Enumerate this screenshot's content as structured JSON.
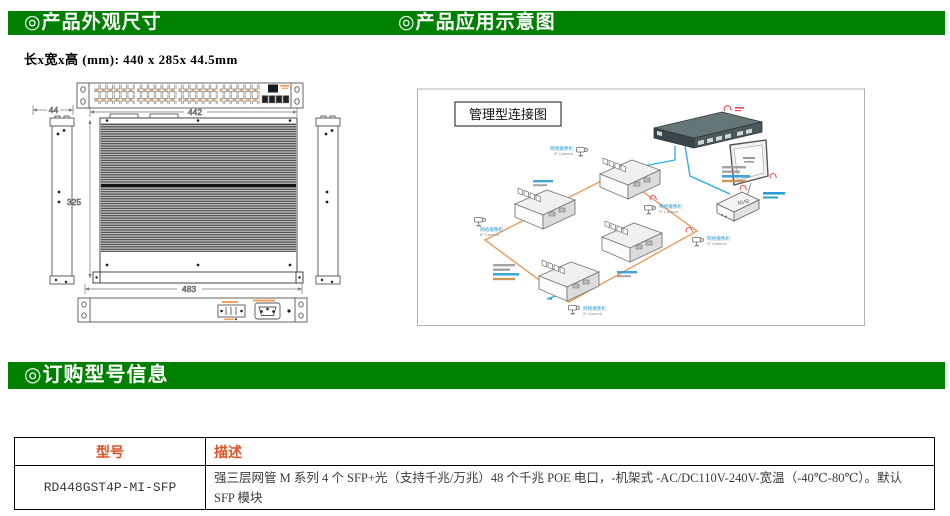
{
  "colors": {
    "green": "#008000",
    "headerText": "#ffffff",
    "tableHeader": "#e05126",
    "orange": "#f0984e",
    "ringOrange": "#eb9c5c",
    "cableBlue": "#29abe2",
    "labelBlue": "#2e9bd6",
    "lineGray": "#555555",
    "dimGray": "#757575",
    "red": "#e8434c"
  },
  "section_headers": {
    "appearance": "◎产品外观尺寸",
    "application": "◎产品应用示意图",
    "ordering": "◎订购型号信息"
  },
  "dimensions_note": "长x宽x高 (mm): 440 x 285x 44.5mm",
  "drawing": {
    "front_width": "442",
    "body_depth": "325",
    "side_width": "44",
    "overall_width": "483"
  },
  "diagram": {
    "title": "管理型连接图",
    "camera_label_cn": "网络摄像机",
    "camera_label_en": "IP Camera",
    "nvr_label": "NVR"
  },
  "order_table": {
    "headers": {
      "model": "型号",
      "description": "描述"
    },
    "rows": [
      {
        "model": "RD448GST4P-MI-SFP",
        "description": "强三层网管 M 系列 4 个 SFP+光（支持千兆/万兆）48 个千兆 POE 电口，-机架式 -AC/DC110V-240V-宽温（-40℃-80℃）。默认 SFP 模块"
      }
    ]
  }
}
